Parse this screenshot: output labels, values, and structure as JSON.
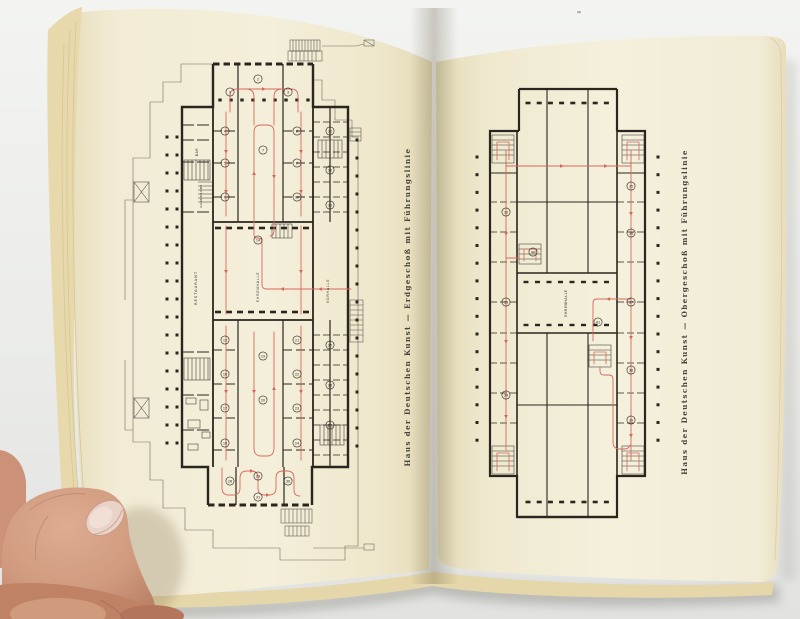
{
  "scene": {
    "description": "Open book spread photographed at an angle; two floor plans of the Haus der Deutschen Kunst with red guidance (tour) lines; a thumb holds the left page",
    "background_color": "#edeeec",
    "page_color": "#f2ecd6",
    "page_edge_color": "#e6d7ab",
    "ink_color": "#2a261f",
    "route_color": "#d9685a",
    "skin_color": "#cf9b81",
    "nail_color": "#e9d3c8"
  },
  "left_page": {
    "caption": "Haus der Deutschen Kunst  —  Erdgeschoß mit Führungslinie",
    "plan": {
      "labels": {
        "restaurant": "RESTAURANT",
        "ehrenhalle": "EHRENHALLE",
        "vorhalle": "VORHALLE",
        "bar": "BAR",
        "garderobe": "GARDEROBE"
      },
      "room_circles": [
        [
          230,
          92,
          "1"
        ],
        [
          258,
          79,
          "2"
        ],
        [
          288,
          92,
          "3"
        ],
        [
          225,
          131,
          "4"
        ],
        [
          225,
          163,
          "5"
        ],
        [
          225,
          197,
          "6"
        ],
        [
          263,
          150,
          "7"
        ],
        [
          297,
          131,
          "8"
        ],
        [
          297,
          163,
          "9"
        ],
        [
          297,
          197,
          "10"
        ],
        [
          330,
          131,
          "11"
        ],
        [
          330,
          170,
          "12"
        ],
        [
          330,
          205,
          "13"
        ],
        [
          258,
          240,
          "14"
        ],
        [
          225,
          340,
          "15"
        ],
        [
          225,
          374,
          "16"
        ],
        [
          225,
          408,
          "17"
        ],
        [
          225,
          443,
          "18"
        ],
        [
          263,
          356,
          "19"
        ],
        [
          263,
          400,
          "20"
        ],
        [
          297,
          340,
          "21"
        ],
        [
          297,
          374,
          "22"
        ],
        [
          297,
          408,
          "23"
        ],
        [
          297,
          443,
          "24"
        ],
        [
          330,
          345,
          "25"
        ],
        [
          330,
          385,
          "26"
        ],
        [
          330,
          425,
          "27"
        ],
        [
          230,
          481,
          "28"
        ],
        [
          258,
          476,
          "29"
        ],
        [
          288,
          481,
          "30"
        ],
        [
          258,
          497,
          "31"
        ]
      ]
    }
  },
  "right_page": {
    "caption": "Haus der Deutschen Kunst  —  Obergeschoß mit Führungslinie",
    "plan": {
      "labels": {
        "ehrenhalle": "EHRENHALLE"
      },
      "room_circles": [
        [
          506,
          212,
          "32"
        ],
        [
          506,
          302,
          "33"
        ],
        [
          506,
          395,
          "34"
        ],
        [
          631,
          186,
          "35"
        ],
        [
          631,
          233,
          "36"
        ],
        [
          631,
          302,
          "37"
        ],
        [
          631,
          370,
          "38"
        ],
        [
          631,
          420,
          "39"
        ],
        [
          533,
          252,
          "40"
        ],
        [
          598,
          322,
          "41"
        ]
      ]
    }
  }
}
